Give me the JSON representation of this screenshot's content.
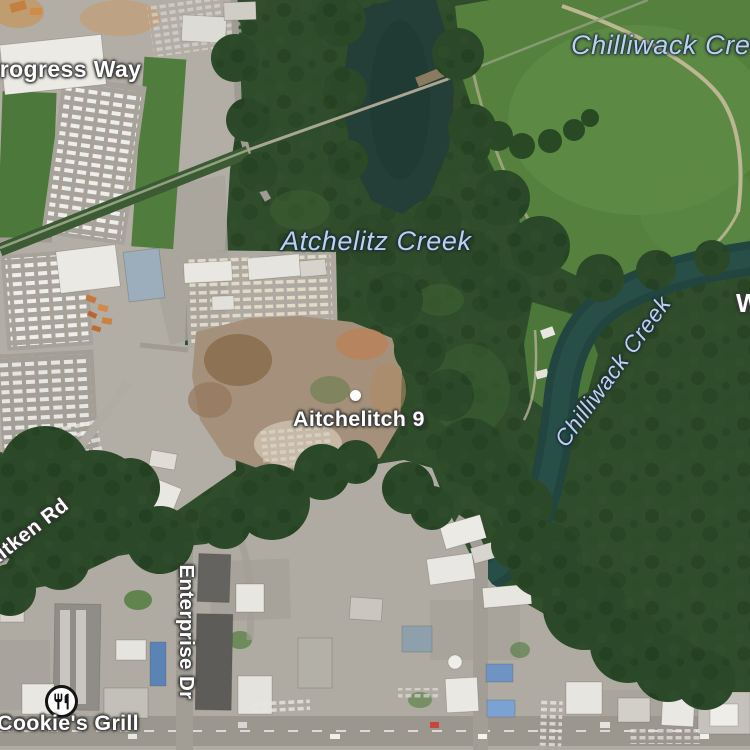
{
  "map": {
    "view": "satellite",
    "labels": {
      "progress_way": "Progress Way",
      "chilliwack_creek_upper": "Chilliwack Creek",
      "atchelitz_creek": "Atchelitz Creek",
      "chilliwack_creek_lower": "Chilliwack Creek",
      "aitchelitch_9": "Aitchelitch 9",
      "aitken_rd": "Aitken Rd",
      "enterprise_dr": "Enterprise Dr",
      "cookies_grill": "Cookie's Grill",
      "partial_road_label": "W"
    },
    "icons": {
      "restaurant": "fork-and-knife"
    },
    "colors": {
      "road_label": "#ffffff",
      "water_label": "#bad2ee",
      "forest": "#2f4c2b",
      "field": "#55803e",
      "water": "#223f38",
      "industrial_ground": "#b2aea5",
      "dirt": "#a5917b",
      "road": "#a29e95"
    }
  }
}
